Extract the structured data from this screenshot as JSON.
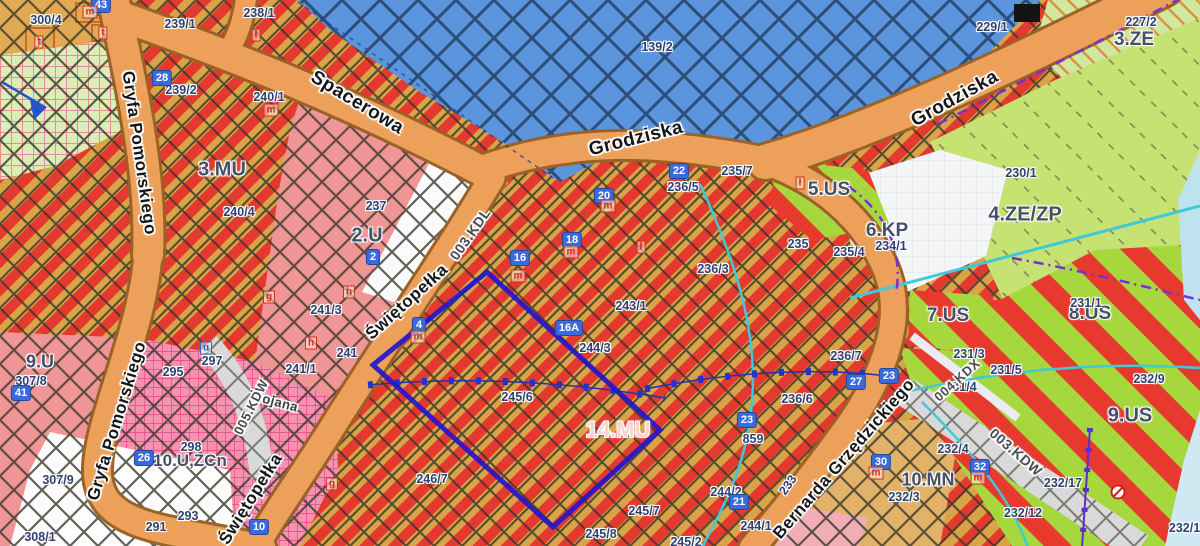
{
  "map": {
    "palette": {
      "zone-label": "#454f66",
      "label-navy": "#2e4170",
      "street": "#141618",
      "badge": "#3a6bdc",
      "marker-red": "#cf2b1c",
      "road-orange": "#eca05a",
      "road-casing": "#9a6226",
      "mu-red": "#e3392e",
      "mu-gold": "#d9a447",
      "water-blue": "#5b95dd",
      "water-hatch": "#28466e",
      "pink-zone": "#ef9596",
      "magenta-zone": "#f593ad",
      "us-green": "#a6d83d",
      "us-red": "#e8392e",
      "ze-green": "#cfe79f",
      "zezp-green": "#c6e272",
      "selection-blue": "#2217cc",
      "cyan-line": "#3fc9d9",
      "purple-line": "#7a2fd0",
      "grey-road": "#d9d9d9"
    },
    "labels": [
      {
        "k": "z",
        "t": "3.MU",
        "x": 222,
        "y": 170
      },
      {
        "k": "z",
        "t": "2.U",
        "x": 367,
        "y": 236
      },
      {
        "k": "z",
        "t": "9.U",
        "x": 40,
        "y": 362,
        "s": 18
      },
      {
        "k": "z",
        "t": "14.MU",
        "x": 618,
        "y": 430,
        "s": 22,
        "c": "#f6d5cf"
      },
      {
        "k": "z",
        "t": "5.US",
        "x": 829,
        "y": 190,
        "s": 19
      },
      {
        "k": "z",
        "t": "6.KP",
        "x": 887,
        "y": 231,
        "s": 19
      },
      {
        "k": "z",
        "t": "4.ZE/ZP",
        "x": 1025,
        "y": 215
      },
      {
        "k": "z",
        "t": "3.ZE",
        "x": 1134,
        "y": 40,
        "s": 19
      },
      {
        "k": "z",
        "t": "7.US",
        "x": 948,
        "y": 316,
        "s": 19
      },
      {
        "k": "z",
        "t": "8.US",
        "x": 1090,
        "y": 314,
        "s": 19
      },
      {
        "k": "z",
        "t": "9.US",
        "x": 1130,
        "y": 416
      },
      {
        "k": "z",
        "t": "10.MN",
        "x": 928,
        "y": 480,
        "s": 18
      },
      {
        "k": "z",
        "t": "10.U,ZCn",
        "x": 190,
        "y": 461,
        "s": 17
      },
      {
        "k": "p",
        "t": "139/2",
        "x": 657,
        "y": 47
      },
      {
        "k": "p",
        "t": "300/4",
        "x": 46,
        "y": 20
      },
      {
        "k": "p",
        "t": "239/1",
        "x": 180,
        "y": 24
      },
      {
        "k": "p",
        "t": "238/1",
        "x": 259,
        "y": 13
      },
      {
        "k": "p",
        "t": "239/2",
        "x": 181,
        "y": 90
      },
      {
        "k": "p",
        "t": "240/1",
        "x": 269,
        "y": 97
      },
      {
        "k": "p",
        "t": "240/4",
        "x": 239,
        "y": 212
      },
      {
        "k": "p",
        "t": "237",
        "x": 376,
        "y": 206
      },
      {
        "k": "p",
        "t": "241/3",
        "x": 326,
        "y": 310
      },
      {
        "k": "p",
        "t": "241",
        "x": 347,
        "y": 353
      },
      {
        "k": "p",
        "t": "241/1",
        "x": 301,
        "y": 369
      },
      {
        "k": "p",
        "t": "295",
        "x": 173,
        "y": 372
      },
      {
        "k": "p",
        "t": "297",
        "x": 212,
        "y": 361
      },
      {
        "k": "p",
        "t": "298",
        "x": 191,
        "y": 447
      },
      {
        "k": "p",
        "t": "293",
        "x": 188,
        "y": 516
      },
      {
        "k": "p",
        "t": "291",
        "x": 156,
        "y": 527
      },
      {
        "k": "p",
        "t": "307/8",
        "x": 31,
        "y": 381
      },
      {
        "k": "p",
        "t": "307/9",
        "x": 58,
        "y": 480
      },
      {
        "k": "p",
        "t": "308/1",
        "x": 40,
        "y": 537
      },
      {
        "k": "p",
        "t": "235/7",
        "x": 737,
        "y": 171
      },
      {
        "k": "p",
        "t": "236/5",
        "x": 683,
        "y": 187
      },
      {
        "k": "p",
        "t": "236/3",
        "x": 713,
        "y": 269
      },
      {
        "k": "p",
        "t": "243/1",
        "x": 631,
        "y": 306
      },
      {
        "k": "p",
        "t": "244/3",
        "x": 595,
        "y": 348
      },
      {
        "k": "p",
        "t": "245/6",
        "x": 517,
        "y": 397
      },
      {
        "k": "p",
        "t": "246/7",
        "x": 432,
        "y": 479
      },
      {
        "k": "p",
        "t": "245/8",
        "x": 601,
        "y": 534
      },
      {
        "k": "p",
        "t": "245/7",
        "x": 644,
        "y": 511
      },
      {
        "k": "p",
        "t": "245/2",
        "x": 686,
        "y": 542
      },
      {
        "k": "p",
        "t": "244/2",
        "x": 726,
        "y": 492
      },
      {
        "k": "p",
        "t": "244/1",
        "x": 756,
        "y": 526
      },
      {
        "k": "p",
        "t": "236/6",
        "x": 797,
        "y": 399
      },
      {
        "k": "p",
        "t": "236/7",
        "x": 846,
        "y": 356
      },
      {
        "k": "p",
        "t": "859",
        "x": 753,
        "y": 439
      },
      {
        "k": "p",
        "t": "235",
        "x": 798,
        "y": 244
      },
      {
        "k": "p",
        "t": "235/4",
        "x": 849,
        "y": 252
      },
      {
        "k": "p",
        "t": "234/1",
        "x": 891,
        "y": 246
      },
      {
        "k": "p",
        "t": "230/1",
        "x": 1021,
        "y": 173
      },
      {
        "k": "p",
        "t": "227/2",
        "x": 1141,
        "y": 22
      },
      {
        "k": "p",
        "t": "229/1",
        "x": 992,
        "y": 27
      },
      {
        "k": "p",
        "t": "231/1",
        "x": 1086,
        "y": 303
      },
      {
        "k": "p",
        "t": "231/3",
        "x": 969,
        "y": 354
      },
      {
        "k": "p",
        "t": "231/4",
        "x": 961,
        "y": 387
      },
      {
        "k": "p",
        "t": "231/5",
        "x": 1006,
        "y": 370
      },
      {
        "k": "p",
        "t": "232/9",
        "x": 1149,
        "y": 379
      },
      {
        "k": "p",
        "t": "232/17",
        "x": 1063,
        "y": 483
      },
      {
        "k": "p",
        "t": "232/12",
        "x": 1023,
        "y": 513
      },
      {
        "k": "p",
        "t": "232/18",
        "x": 1188,
        "y": 528
      },
      {
        "k": "p",
        "t": "232/4",
        "x": 953,
        "y": 449
      },
      {
        "k": "p",
        "t": "232/3",
        "x": 904,
        "y": 497
      },
      {
        "k": "p",
        "t": "233",
        "x": 788,
        "y": 485,
        "r": -55
      },
      {
        "k": "s",
        "t": "Gryfa Pomorskiego",
        "x": 139,
        "y": 153,
        "r": 82
      },
      {
        "k": "s",
        "t": "Gryfa Pomorskiego",
        "x": 117,
        "y": 421,
        "r": -73
      },
      {
        "k": "s",
        "t": "Spacerowa",
        "x": 357,
        "y": 103,
        "r": 31,
        "s": 19
      },
      {
        "k": "s",
        "t": "Grodziska",
        "x": 636,
        "y": 139,
        "r": -14,
        "s": 19
      },
      {
        "k": "s",
        "t": "Grodziska",
        "x": 955,
        "y": 99,
        "r": -29,
        "s": 19
      },
      {
        "k": "s",
        "t": "Świętopełka",
        "x": 407,
        "y": 302,
        "r": -42
      },
      {
        "k": "s",
        "t": "Świętopełka",
        "x": 251,
        "y": 499,
        "r": -58
      },
      {
        "k": "s",
        "t": "Bernarda Grzędzickiego",
        "x": 844,
        "y": 459,
        "r": -49
      },
      {
        "k": "s",
        "t": "Trojana",
        "x": 274,
        "y": 401,
        "r": 15,
        "s": 13,
        "c": "#3a3f44"
      },
      {
        "k": "s",
        "t": "003.KDL",
        "x": 470,
        "y": 234,
        "r": -55,
        "s": 14,
        "c": "#474c55"
      },
      {
        "k": "s",
        "t": "003.KDW",
        "x": 1016,
        "y": 452,
        "r": 41,
        "s": 14,
        "c": "#474c55"
      },
      {
        "k": "s",
        "t": "004.KDX",
        "x": 957,
        "y": 380,
        "r": -42,
        "s": 13,
        "c": "#474c55"
      },
      {
        "k": "s",
        "t": "005.KDW",
        "x": 251,
        "y": 407,
        "r": -63,
        "s": 13,
        "c": "#474c55"
      },
      {
        "k": "b",
        "t": "43",
        "x": 101,
        "y": 5
      },
      {
        "k": "b",
        "t": "28",
        "x": 162,
        "y": 78
      },
      {
        "k": "b",
        "t": "2",
        "x": 373,
        "y": 257
      },
      {
        "k": "b",
        "t": "41",
        "x": 21,
        "y": 393
      },
      {
        "k": "b",
        "t": "26",
        "x": 144,
        "y": 458
      },
      {
        "k": "b",
        "t": "10",
        "x": 259,
        "y": 527
      },
      {
        "k": "b",
        "t": "16",
        "x": 520,
        "y": 258
      },
      {
        "k": "b",
        "t": "18",
        "x": 572,
        "y": 240
      },
      {
        "k": "b",
        "t": "20",
        "x": 604,
        "y": 196
      },
      {
        "k": "b",
        "t": "22",
        "x": 679,
        "y": 171
      },
      {
        "k": "b",
        "t": "16A",
        "x": 569,
        "y": 328
      },
      {
        "k": "b",
        "t": "4",
        "x": 419,
        "y": 325
      },
      {
        "k": "b",
        "t": "23",
        "x": 747,
        "y": 420
      },
      {
        "k": "b",
        "t": "27",
        "x": 856,
        "y": 382
      },
      {
        "k": "b",
        "t": "23",
        "x": 889,
        "y": 376
      },
      {
        "k": "b",
        "t": "21",
        "x": 739,
        "y": 502
      },
      {
        "k": "b",
        "t": "30",
        "x": 881,
        "y": 462
      },
      {
        "k": "b",
        "t": "32",
        "x": 980,
        "y": 467
      },
      {
        "k": "m",
        "t": "m",
        "x": 90,
        "y": 12
      },
      {
        "k": "m",
        "t": "t",
        "x": 103,
        "y": 33
      },
      {
        "k": "m",
        "t": "t",
        "x": 39,
        "y": 42
      },
      {
        "k": "m",
        "t": "ł",
        "x": 256,
        "y": 35
      },
      {
        "k": "m",
        "t": "m",
        "x": 271,
        "y": 110
      },
      {
        "k": "m",
        "t": "m",
        "x": 608,
        "y": 206
      },
      {
        "k": "m",
        "t": "m",
        "x": 571,
        "y": 252
      },
      {
        "k": "m",
        "t": "m",
        "x": 518,
        "y": 276
      },
      {
        "k": "m",
        "t": "m",
        "x": 418,
        "y": 337
      },
      {
        "k": "m",
        "t": "h",
        "x": 349,
        "y": 292
      },
      {
        "k": "m",
        "t": "h",
        "x": 311,
        "y": 343
      },
      {
        "k": "m",
        "t": "g",
        "x": 269,
        "y": 297
      },
      {
        "k": "m",
        "t": "u",
        "x": 206,
        "y": 348,
        "c": "#2f62d8"
      },
      {
        "k": "m",
        "t": "ł",
        "x": 641,
        "y": 247
      },
      {
        "k": "m",
        "t": "ł",
        "x": 800,
        "y": 183
      },
      {
        "k": "m",
        "t": "g",
        "x": 332,
        "y": 484
      },
      {
        "k": "m",
        "t": "m",
        "x": 876,
        "y": 473
      },
      {
        "k": "m",
        "t": "m",
        "x": 978,
        "y": 478
      }
    ]
  }
}
